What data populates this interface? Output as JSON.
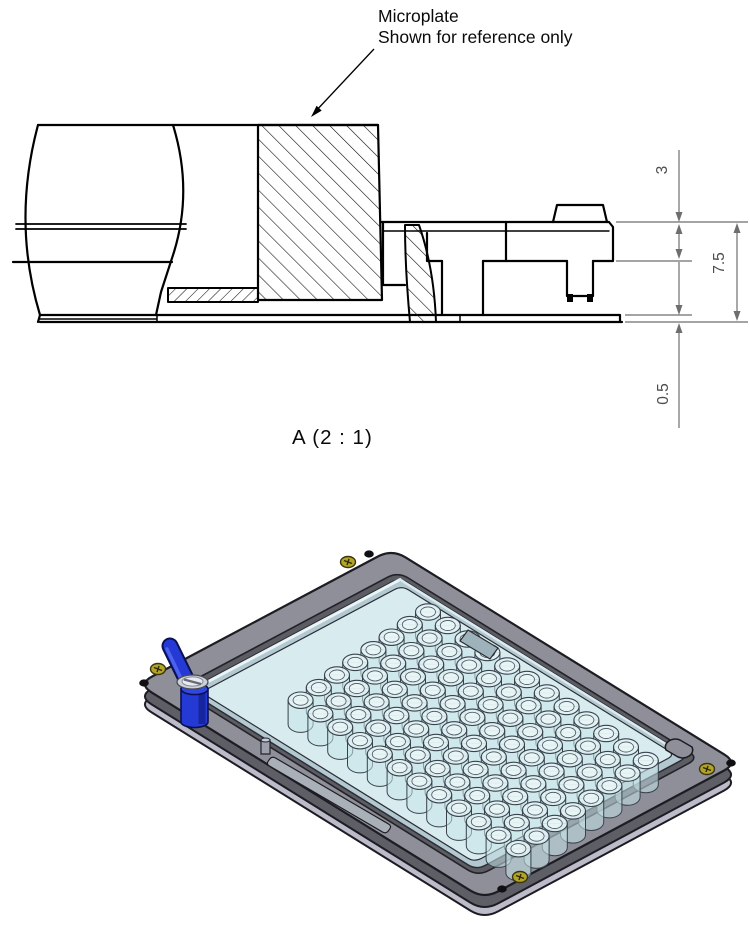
{
  "detail_view": {
    "callout_line1": "Microplate",
    "callout_line2": "Shown for reference only",
    "view_label": "A  (2 : 1)",
    "dimensions": {
      "flange_height": "3",
      "overall_height": "7.5",
      "bottom_lip": "0.5"
    }
  },
  "isometric_view": {
    "wells": {
      "rows": 8,
      "cols": 12
    },
    "colors": {
      "frame_top": "#8f8f99",
      "frame_side": "#5e5e66",
      "frame_rim": "#bbbbc9",
      "pocket": "#5c5c64",
      "plate_rim": "#b3c9d2",
      "plate_deck": "#d8ebef",
      "well_fill": "#c9e5ea",
      "well_top": "#e2f2f5",
      "outline": "#1c1c22",
      "lever_blue": "#2539d4",
      "lever_blue_dark": "#0a1150",
      "lever_blue_light": "#4c62ee",
      "screw_yellow": "#b2a427",
      "screw_silver": "#cdd1d9",
      "hole_black": "#101014"
    }
  }
}
